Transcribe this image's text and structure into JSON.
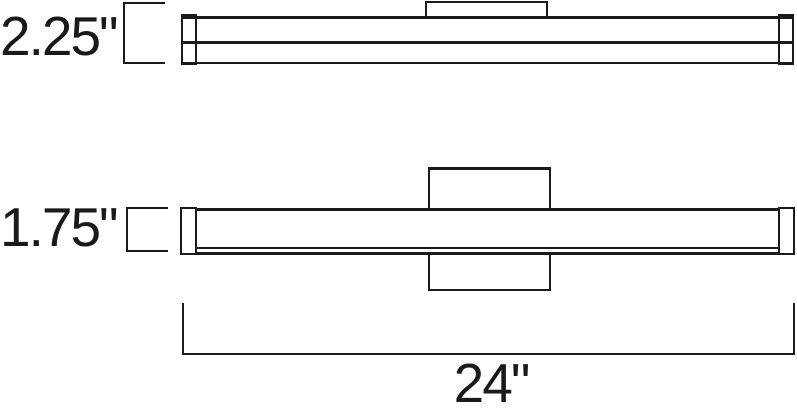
{
  "diagram": {
    "background": "#ffffff",
    "line_color": "#1a1a1a",
    "labels": {
      "depth": "2.25\"",
      "height": "1.75\"",
      "width": "24\""
    }
  }
}
